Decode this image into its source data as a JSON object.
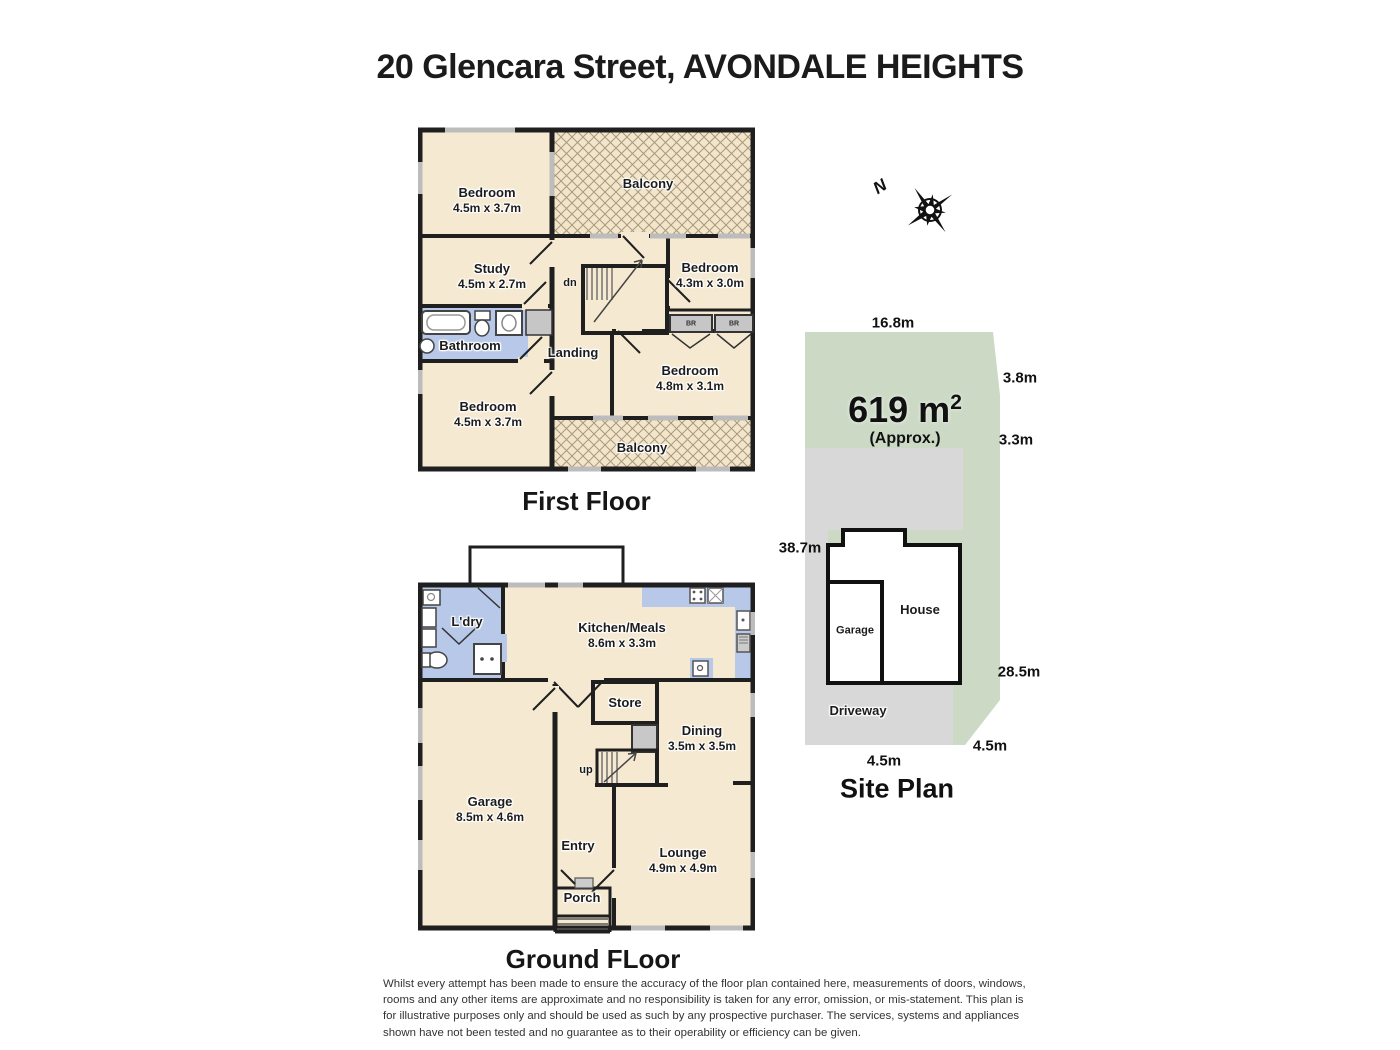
{
  "title": "20 Glencara Street, AVONDALE HEIGHTS",
  "compass": {
    "north": "N"
  },
  "first_floor": {
    "caption": "First Floor",
    "stair": "dn",
    "robes": [
      "BR",
      "BR"
    ],
    "rooms": [
      {
        "name": "Bedroom",
        "dims": "4.5m x 3.7m"
      },
      {
        "name": "Balcony",
        "dims": ""
      },
      {
        "name": "Study",
        "dims": "4.5m x 2.7m"
      },
      {
        "name": "Bedroom",
        "dims": "4.3m x 3.0m"
      },
      {
        "name": "Bathroom",
        "dims": ""
      },
      {
        "name": "Landing",
        "dims": ""
      },
      {
        "name": "Bedroom",
        "dims": "4.8m x 3.1m"
      },
      {
        "name": "Bedroom",
        "dims": "4.5m x 3.7m"
      },
      {
        "name": "Balcony",
        "dims": ""
      }
    ]
  },
  "ground_floor": {
    "caption": "Ground FLoor",
    "stair": "up",
    "rooms": [
      {
        "name": "L'dry",
        "dims": ""
      },
      {
        "name": "Kitchen/Meals",
        "dims": "8.6m x 3.3m"
      },
      {
        "name": "Store",
        "dims": ""
      },
      {
        "name": "Dining",
        "dims": "3.5m x 3.5m"
      },
      {
        "name": "Garage",
        "dims": "8.5m x 4.6m"
      },
      {
        "name": "Entry",
        "dims": ""
      },
      {
        "name": "Lounge",
        "dims": "4.9m x 4.9m"
      },
      {
        "name": "Porch",
        "dims": ""
      }
    ]
  },
  "site_plan": {
    "caption": "Site Plan",
    "area_value": "619 m",
    "area_exponent": "2",
    "area_approx": "(Approx.)",
    "house_label": "House",
    "garage_label": "Garage",
    "driveway_label": "Driveway",
    "dim_top": "16.8m",
    "dim_right_upper": "3.8m",
    "dim_right_mid": "3.3m",
    "dim_left": "38.7m",
    "dim_right_lower": "28.5m",
    "dim_bottom": "4.5m",
    "dim_corner": "4.5m"
  },
  "disclaimer": "Whilst every attempt has been made to ensure the accuracy of the floor plan contained here, measurements of doors, windows, rooms and any other items are approximate and no responsibility is taken for any error, omission, or mis-statement. This plan is for illustrative purposes only and should be used as such by any prospective purchaser. The services, systems and appliances shown have not been tested and no guarantee as to their operability or efficiency can be given.",
  "colors": {
    "wall": "#1f1f1f",
    "room_fill": "#f6e9d2",
    "wet_fill": "#b7c8e8",
    "window_mark": "#bcbcbc",
    "store_grey": "#b2b2b2",
    "site_green": "#cbd9c5",
    "site_grey": "#d8d8d8",
    "text": "#1a1a1a"
  }
}
